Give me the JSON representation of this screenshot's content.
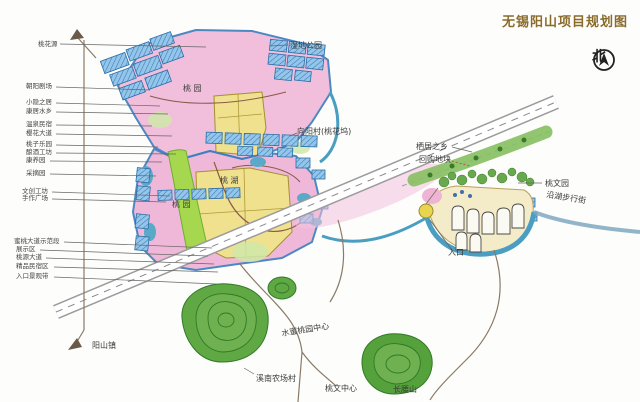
{
  "title": "无锡阳山项目规划图",
  "compass": {
    "north_label": "北"
  },
  "map": {
    "area_labels": {
      "orchard_top": "桃 园",
      "wetland_park": "湿地公园",
      "xiangyang_village": "向阳村(桃花坞)",
      "peach_lake": "桃 湖",
      "orchard_mid": "桃 园",
      "habitat_township": "栖居之乡",
      "repurchase_parcel": "回购地块",
      "peach_culture_park": "桃文园",
      "lakeside_walk_street": "沿湖步行街",
      "entrance": "入口",
      "peach_center_road": "水蜜桃园中心",
      "xinan_farm_village": "溪南农场村",
      "peach_culture_center": "桃文中心",
      "changyao_hill": "长腰山",
      "yangshan_town": "阳山镇"
    },
    "left_legend": [
      "桃花源",
      "朝阳剧场",
      "小隐之居",
      "康居水乡",
      "温泉民宿",
      "樱花大道",
      "桃子乐园",
      "酿酒工坊",
      "康养园",
      "采摘园",
      "文创工坊",
      "手作广场",
      "蜜桃大道示范段",
      "展示区",
      "桃源大道",
      "精品民宿区",
      "入口景观带"
    ]
  }
}
